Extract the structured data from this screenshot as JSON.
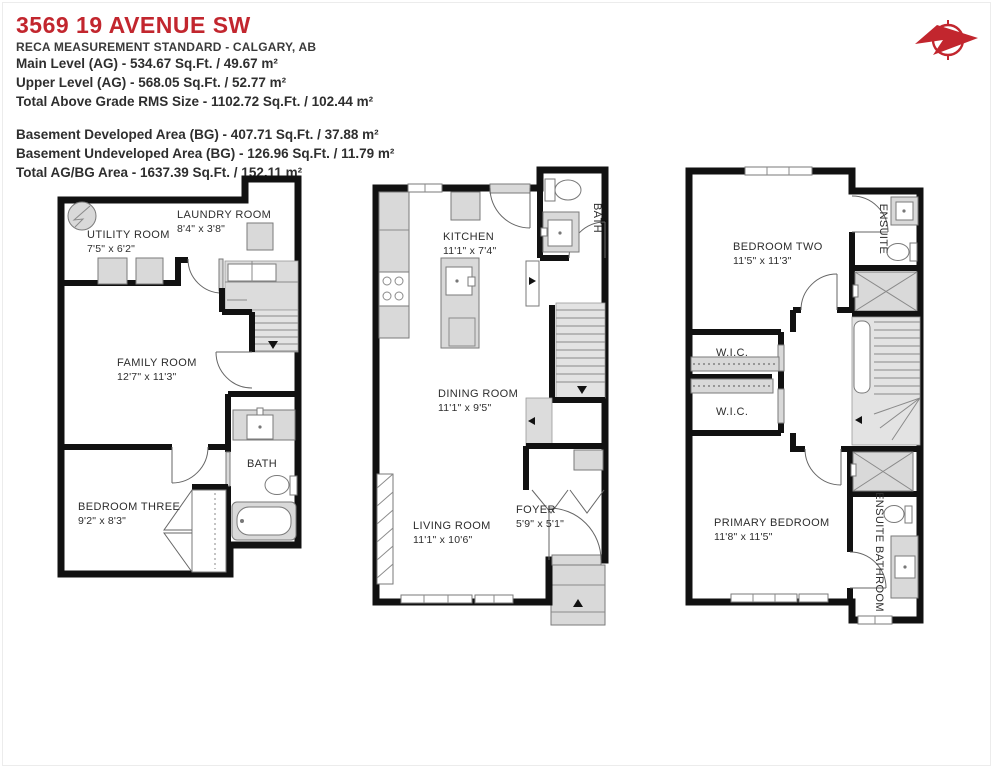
{
  "header": {
    "title": "3569 19 AVENUE SW",
    "subtitle": "RECA MEASUREMENT STANDARD - CALGARY, AB",
    "above_grade": [
      "Main Level (AG) - 534.67 Sq.Ft. / 49.67 m²",
      "Upper Level (AG) - 568.05 Sq.Ft. / 52.77 m²",
      "Total Above Grade RMS Size - 1102.72 Sq.Ft. / 102.44 m²"
    ],
    "below_grade": [
      "Basement Developed Area (BG) - 407.71 Sq.Ft. / 37.88 m²",
      "Basement Undeveloped Area (BG) - 126.96 Sq.Ft. / 11.79 m²",
      "Total AG/BG Area - 1637.39 Sq.Ft. / 152.11 m²"
    ]
  },
  "compass": {
    "icon": "compass-needle-icon",
    "color": "#c2262e"
  },
  "colors": {
    "accent_red": "#c2262e",
    "wall_black": "#111111",
    "fixture_gray": "#d9d9d9",
    "stair_gray": "#e3e3e3",
    "text_dark": "#2d2d2d"
  },
  "basement": {
    "utility": {
      "name": "UTILITY ROOM",
      "dims": "7'5\" x 6'2\""
    },
    "laundry": {
      "name": "LAUNDRY ROOM",
      "dims": "8'4\" x 3'8\""
    },
    "family": {
      "name": "FAMILY ROOM",
      "dims": "12'7\" x 11'3\""
    },
    "bedroom3": {
      "name": "BEDROOM THREE",
      "dims": "9'2\" x 8'3\""
    },
    "bath": {
      "name": "BATH"
    }
  },
  "main_level": {
    "kitchen": {
      "name": "KITCHEN",
      "dims": "11'1\" x 7'4\""
    },
    "dining": {
      "name": "DINING ROOM",
      "dims": "11'1\" x 9'5\""
    },
    "living": {
      "name": "LIVING ROOM",
      "dims": "11'1\" x 10'6\""
    },
    "foyer": {
      "name": "FOYER",
      "dims": "5'9\" x 5'1\""
    },
    "bath": {
      "name": "BATH"
    }
  },
  "upper_level": {
    "bedroom2": {
      "name": "BEDROOM TWO",
      "dims": "11'5\" x 11'3\""
    },
    "ensuite": {
      "name": "ENSUITE"
    },
    "wic1": {
      "name": "W.I.C."
    },
    "wic2": {
      "name": "W.I.C."
    },
    "primary": {
      "name": "PRIMARY BEDROOM",
      "dims": "11'8\" x 11'5\""
    },
    "ensuite_bathroom": {
      "name": "ENSUITE BATHROOM"
    }
  }
}
